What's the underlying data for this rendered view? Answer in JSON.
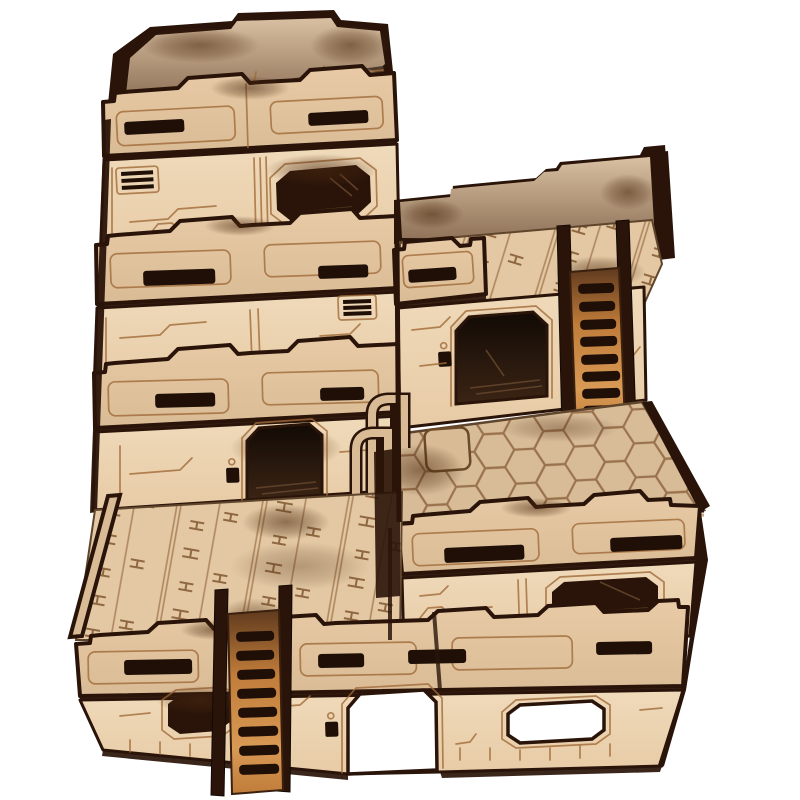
{
  "image": {
    "type": "product-photo",
    "subject": "laser-cut MDF sci-fi terrain building with tiered towers, parapets, ladders and hex-tile roof",
    "background": "#ffffff",
    "width": 800,
    "height": 800
  },
  "palette": {
    "bg": "#ffffff",
    "mdf": "#e8cba6",
    "mdfLight": "#efdaba",
    "mdfDark": "#d9bb95",
    "tread": "#e3c8a3",
    "hexBase": "#d8bc98",
    "hexLine": "#8f6640",
    "etch": "#a06a38",
    "edge": "#2a1409",
    "slot": "#1f0f07",
    "scorch": "#b06a2e",
    "burnCore": "#4a280f",
    "roofHi": "#6a503a",
    "roofLo": "#31221a",
    "parapetHi": "#d9c0a2",
    "parapetLo": "#8f7258",
    "ladderHi": "#d99a55",
    "ladderMid": "#c07c3a",
    "ladderLo": "#5f3a1e"
  },
  "scene": {
    "parts": [
      {
        "name": "tower-left",
        "levels": 3,
        "features": [
          "crenellated-parapets",
          "slit-windows",
          "vent-grilles",
          "oval-window",
          "doorway"
        ]
      },
      {
        "name": "upper-tier-right",
        "features": [
          "crenellated-parapet",
          "treadplate-floor",
          "doorway",
          "keypad",
          "access-ladder"
        ]
      },
      {
        "name": "hex-roof-tier",
        "features": [
          "hex-tile-floor",
          "safety-railings",
          "access-hatch"
        ]
      },
      {
        "name": "lower-terrace-left",
        "features": [
          "treadplate-floor",
          "parapet",
          "oval-window",
          "ground-door",
          "access-ladder"
        ]
      },
      {
        "name": "ground-block-right",
        "features": [
          "parapet-band",
          "oval-window",
          "open-window",
          "etched-panel-lines"
        ]
      }
    ],
    "counts": {
      "ladders": 2,
      "doorways": 3,
      "oval-windows": 4,
      "slit-windows": 13,
      "vent-grilles": 2,
      "keypads": 3,
      "railing-hoops": 2
    }
  }
}
